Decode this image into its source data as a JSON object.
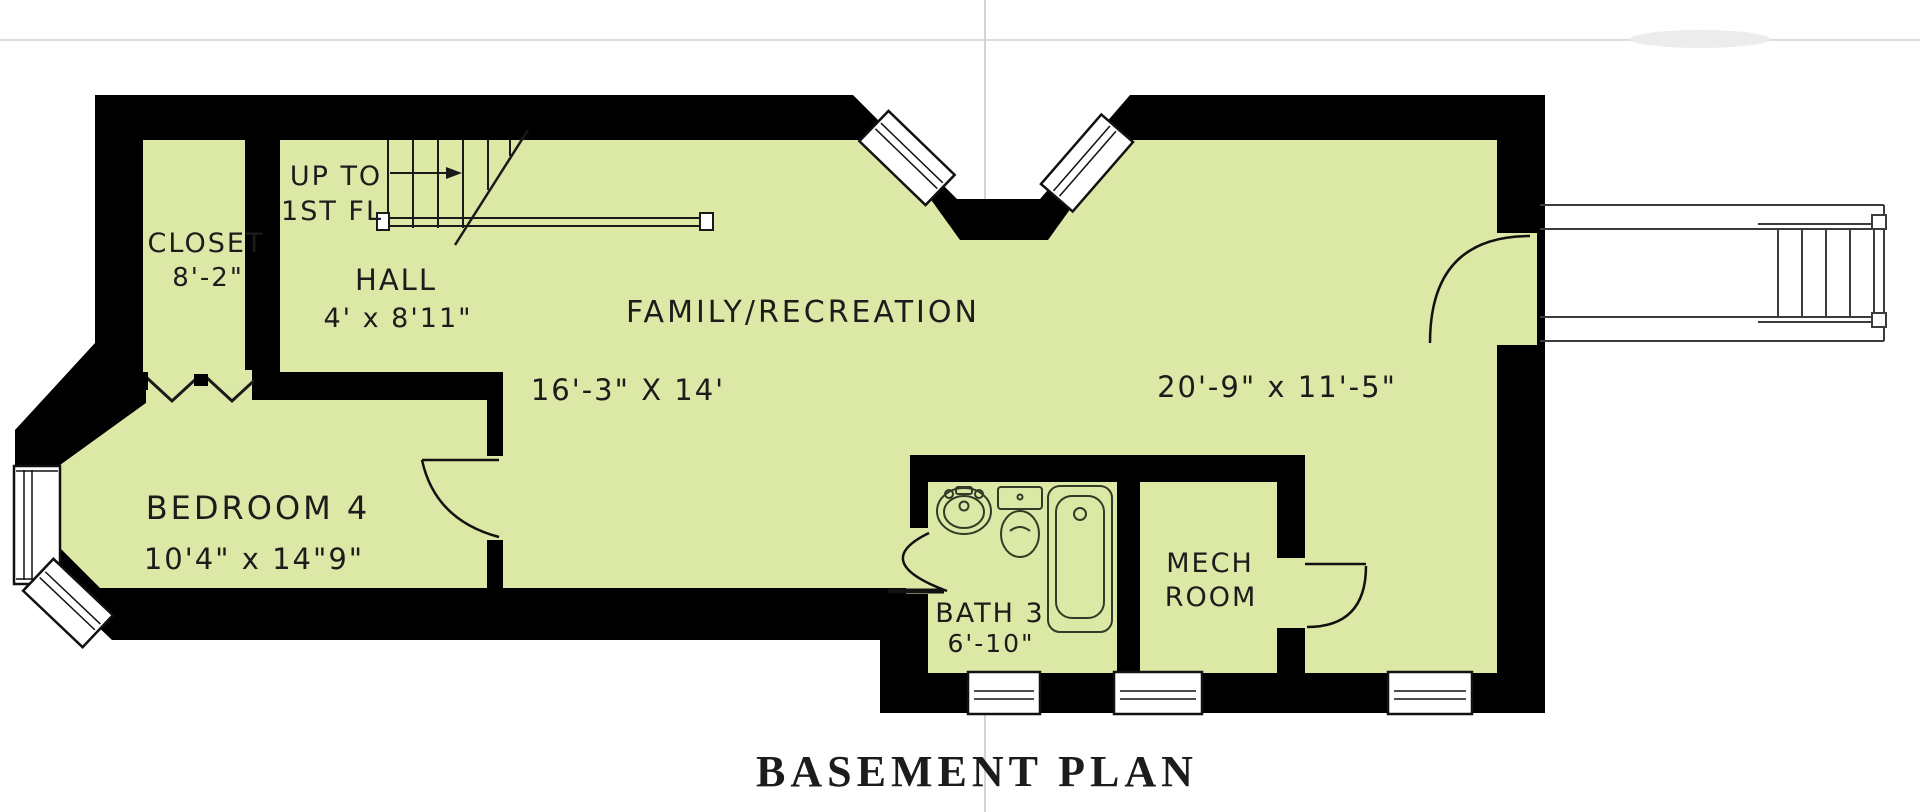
{
  "page": {
    "title_label": "BASEMENT PLAN"
  },
  "colors": {
    "room_fill": "#dce8a5",
    "wall": "#000000",
    "text": "#1c1c1c"
  },
  "rooms": {
    "closet": {
      "name": "CLOSET",
      "dimension": "8'-2\""
    },
    "hall": {
      "name": "HALL",
      "dimension": "4' x 8'11\""
    },
    "stairs": {
      "direction_line1": "UP TO",
      "direction_line2": "1ST FL"
    },
    "family_recreation": {
      "name": "FAMILY/RECREATION",
      "dimension_left": "16'-3\" X 14'",
      "dimension_right": "20'-9\" x 11'-5\""
    },
    "bedroom4": {
      "name": "BEDROOM 4",
      "dimension": "10'4\" x 14\"9\""
    },
    "bath3": {
      "name": "BATH 3",
      "dimension": "6'-10\""
    },
    "mech_room": {
      "name_line1": "MECH",
      "name_line2": "ROOM"
    }
  }
}
